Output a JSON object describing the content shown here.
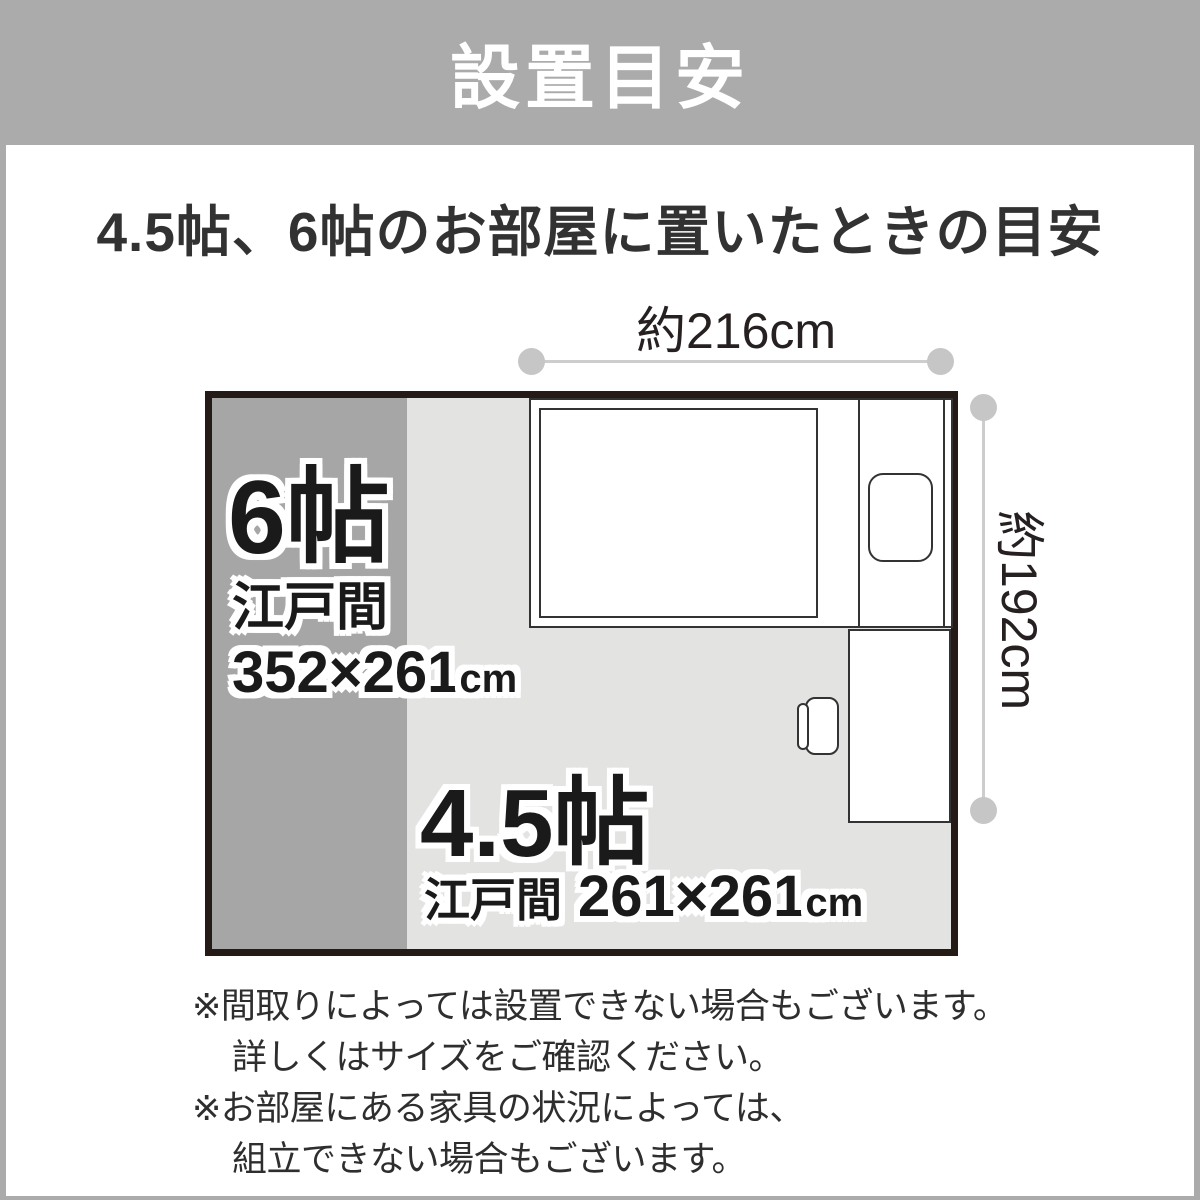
{
  "header": {
    "title": "設置目安"
  },
  "content": {
    "heading": "4.5帖、6帖のお部屋に置いたときの目安"
  },
  "diagram": {
    "width_label": "約216cm",
    "height_label": "約192cm",
    "room_6jo": {
      "size": "6帖",
      "type": "江戸間",
      "dimensions": "352×261",
      "unit": "cm"
    },
    "room_45jo": {
      "size": "4.5帖",
      "type": "江戸間",
      "dimensions": "261×261",
      "unit": "cm"
    },
    "colors": {
      "header_gray": "#ababab",
      "room_6jo_fill": "#a6a6a6",
      "room_45jo_fill": "#e3e3e2",
      "room_border": "#241a16",
      "dimension_line": "#cdcdcd"
    }
  },
  "notes": {
    "line1": "※間取りによっては設置できない場合もございます。",
    "line2": "詳しくはサイズをご確認ください。",
    "line3": "※お部屋にある家具の状況によっては、",
    "line4": "組立できない場合もございます。"
  }
}
